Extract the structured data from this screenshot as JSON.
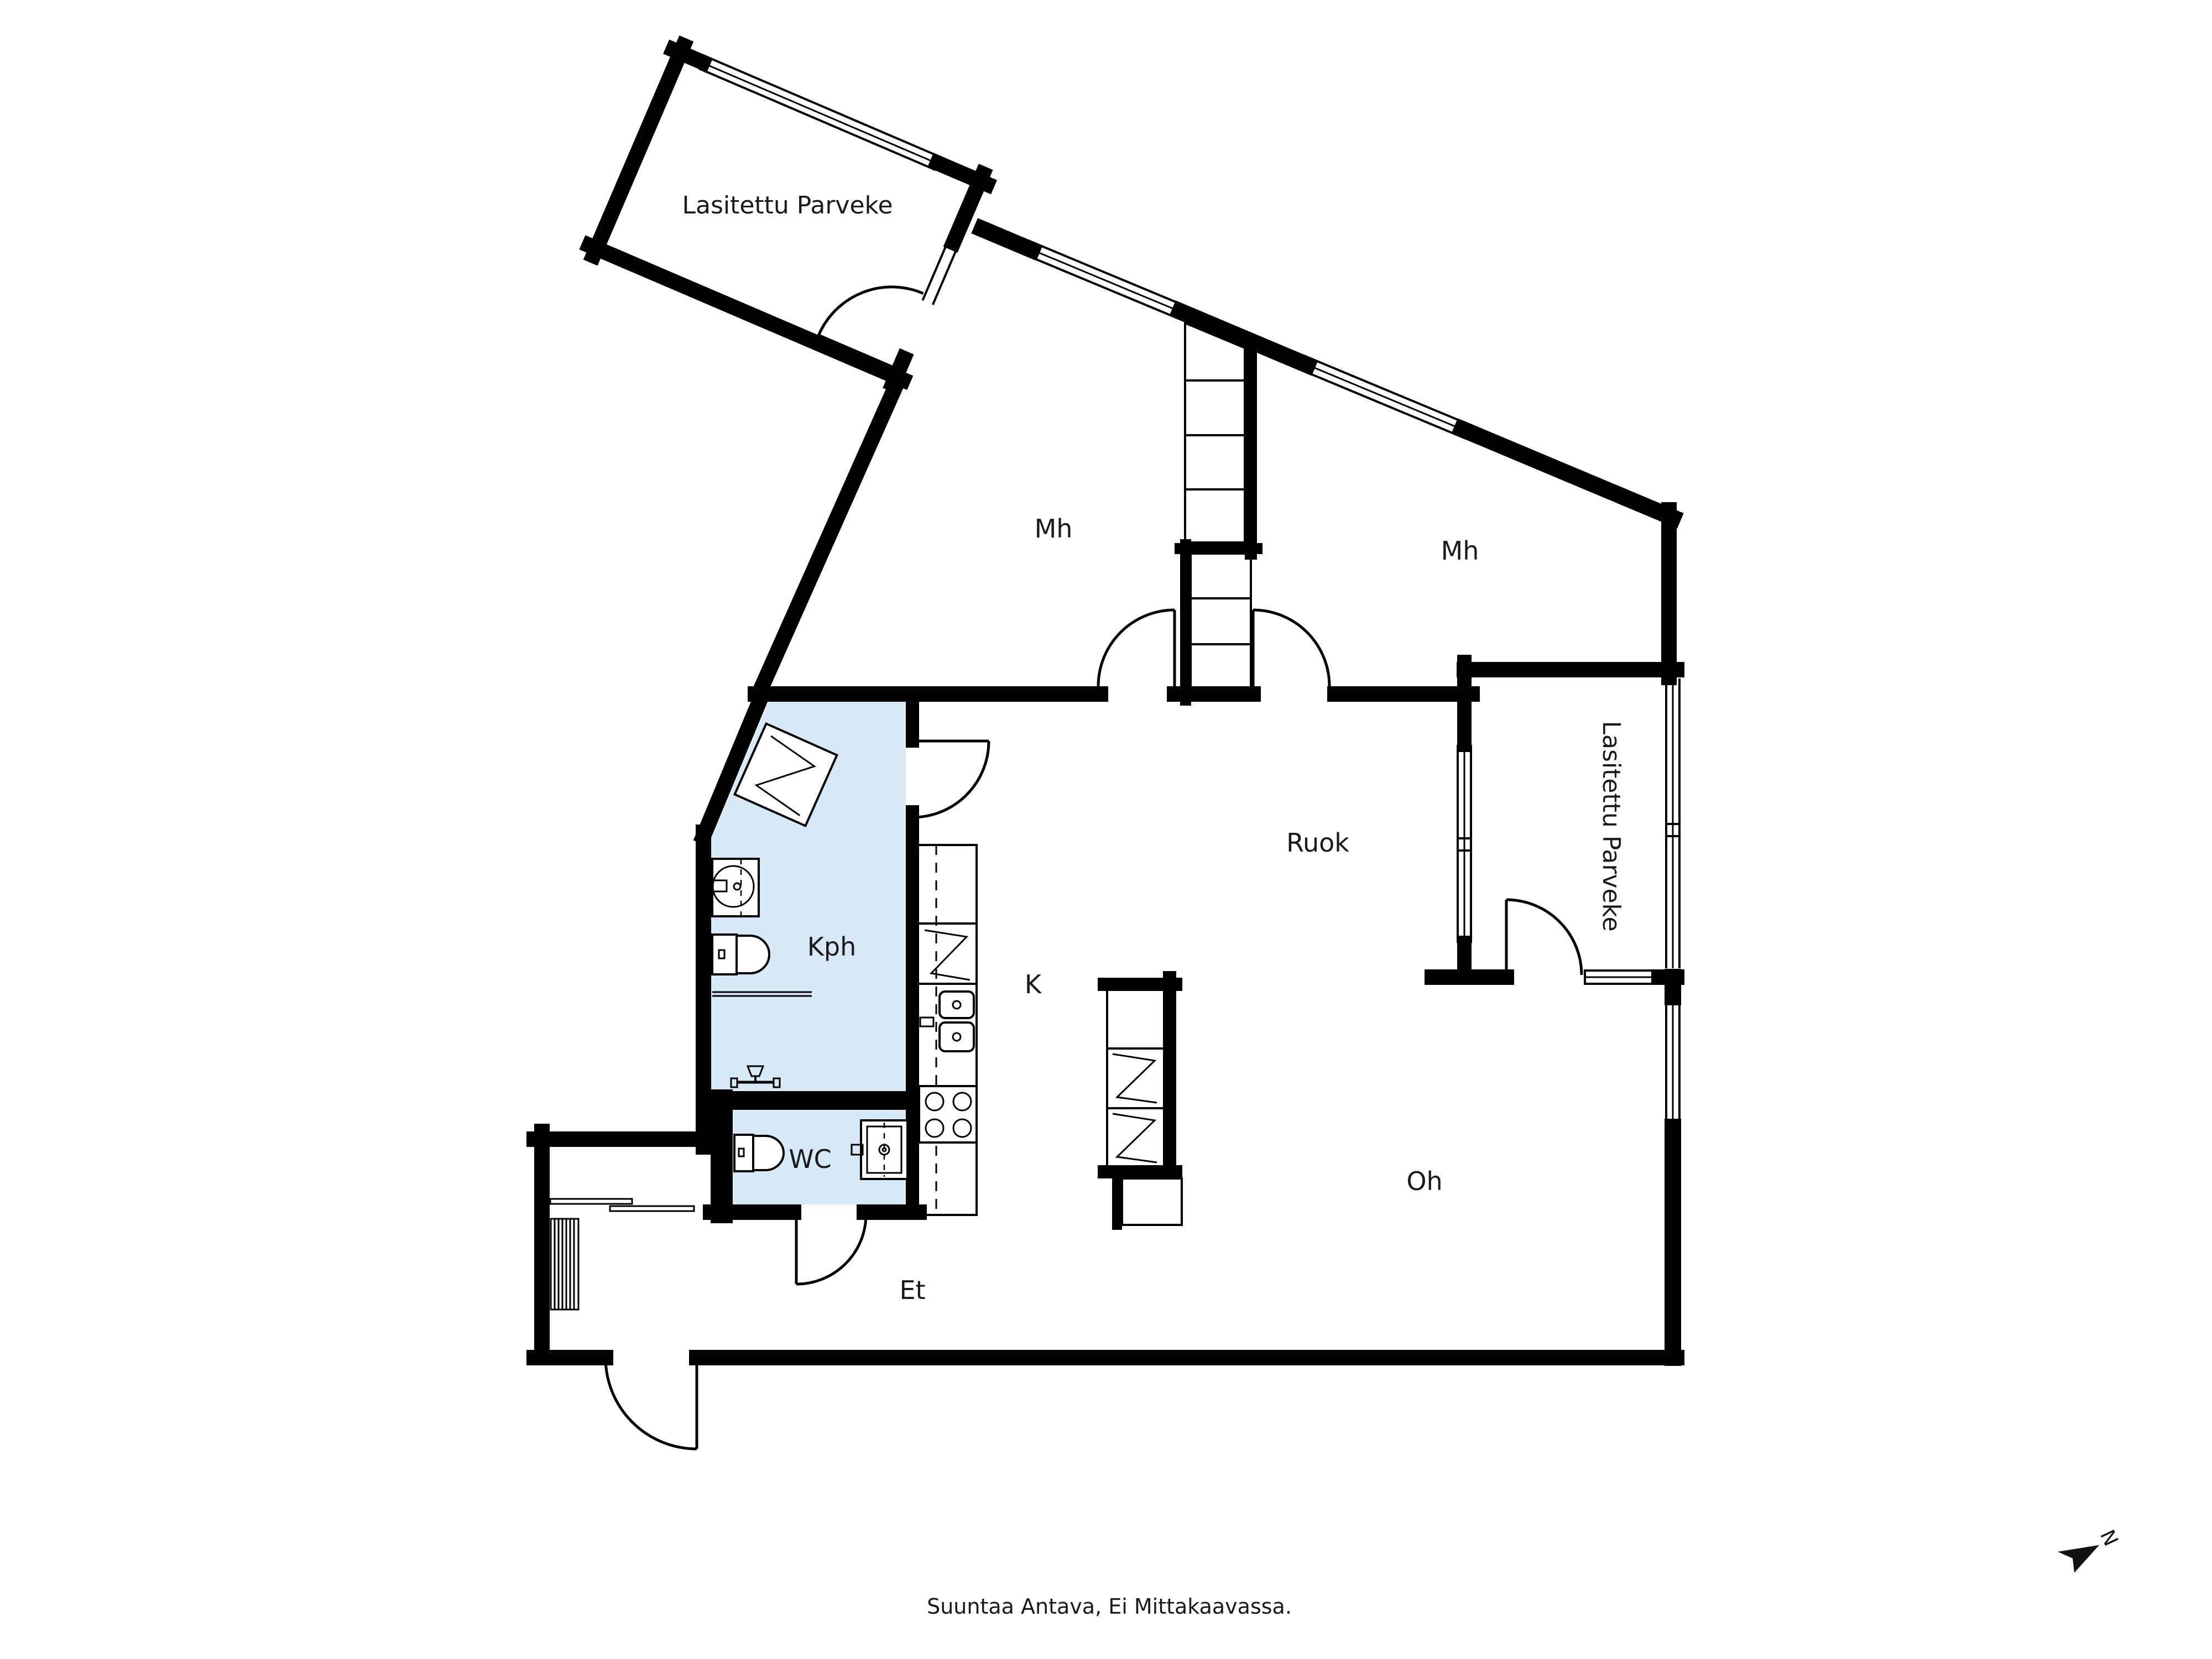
{
  "title": "Asunnon pohjapiirros",
  "colors": {
    "wall": "#000000",
    "wet_room_fill": "#d9e8f6",
    "background": "#ffffff",
    "text": "#1a1a1a"
  },
  "labels": {
    "balcony_top": "Lasitettu Parveke",
    "balcony_right": "Lasitettu Parveke",
    "mh_left": "Mh",
    "mh_right": "Mh",
    "ruok": "Ruok",
    "kph": "Kph",
    "k": "K",
    "wc": "WC",
    "et": "Et",
    "oh": "Oh"
  },
  "footer": {
    "disclaimer": "Suuntaa Antava, Ei Mittakaavassa."
  },
  "compass": {
    "north_label": "N"
  }
}
